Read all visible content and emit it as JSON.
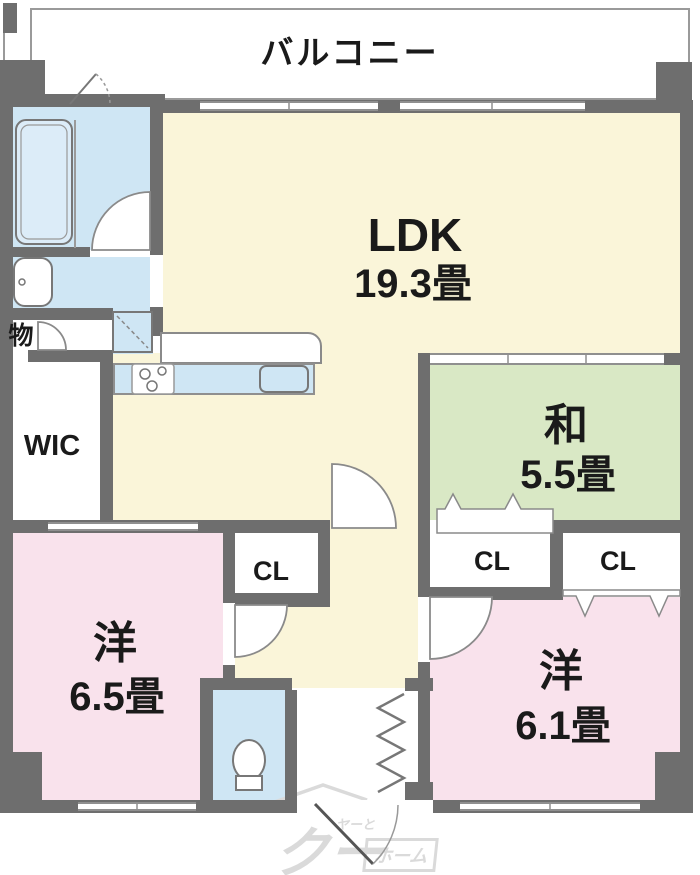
{
  "balcony": {
    "label": "バルコニー"
  },
  "rooms": {
    "ldk": {
      "label": "LDK",
      "size": "19.3畳"
    },
    "japanese_room": {
      "label": "和",
      "size": "5.5畳"
    },
    "western_room_1": {
      "label": "洋",
      "size": "6.5畳"
    },
    "western_room_2": {
      "label": "洋",
      "size": "6.1畳"
    },
    "wic": {
      "label": "WIC"
    },
    "storage": {
      "label": "物"
    }
  },
  "closets": {
    "mid": "CL",
    "left": "CL",
    "right": "CL"
  },
  "watermark": {
    "main": "クー",
    "small": "ヤーと",
    "box": "ホーム"
  },
  "colors": {
    "wall": "#6e6e6e",
    "ldk_floor": "#faf5d9",
    "tatami_floor": "#d9e8c5",
    "bedroom_floor": "#f9e2ec",
    "wet_area_floor": "#cfe6f4",
    "line": "#9a9a9a",
    "label_text": "#1a1a1a",
    "watermark": "#dadada"
  }
}
